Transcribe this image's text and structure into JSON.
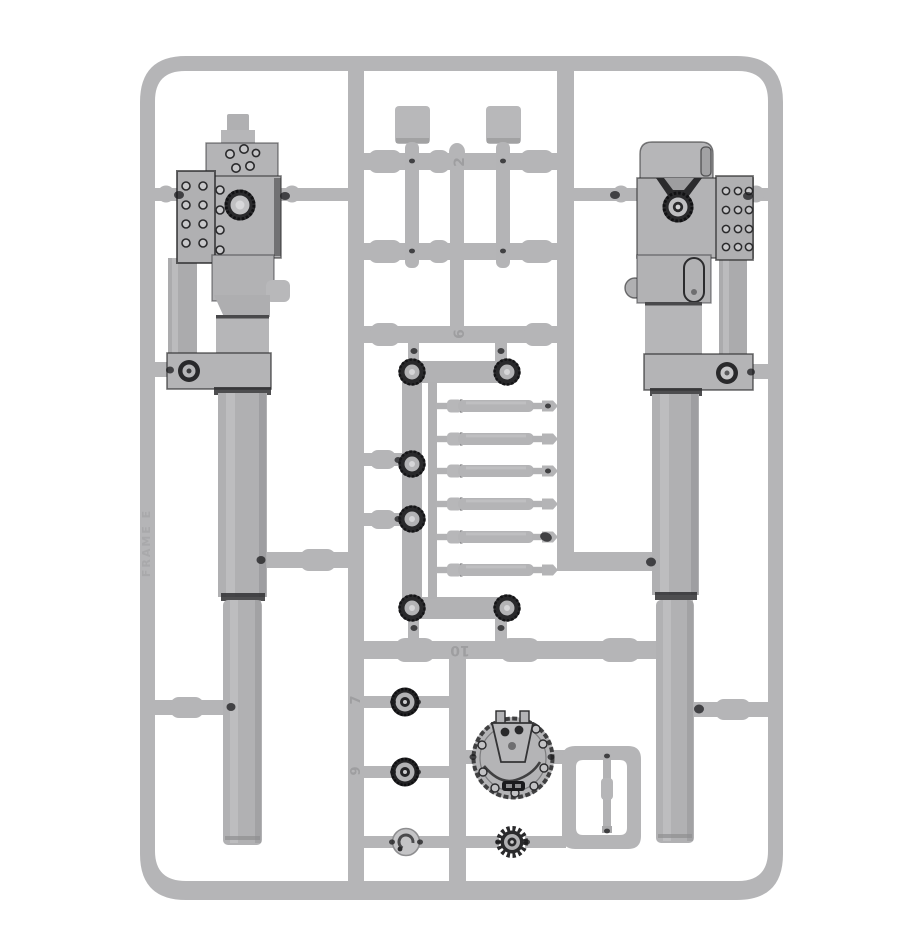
{
  "scene": {
    "description": "Photograph of a grey plastic model-kit sprue (runner frame) holding two heavy cannon assemblies on the sides and small parts in the middle: two flat posts, two trail brackets with eyelet rings, six recoil piston rods, two wheel hubs, a hub cap, a toothed gear, a riveted circular mount plate, a small pin inside a sub-frame.",
    "background_color": "#ffffff",
    "plastic_color": "#b5b5b7",
    "detail_color": "#232325"
  },
  "sprue": {
    "frame_label": "FRAME E",
    "part_numbers": {
      "upper_crossbar": "2",
      "middle_crossbar": "6",
      "lower_crossbar": "10",
      "upper_wheel": "7",
      "lower_wheel": "9"
    },
    "parts": [
      {
        "name": "heavy cannon assembly, left",
        "qty": 1
      },
      {
        "name": "heavy cannon assembly, right",
        "qty": 1
      },
      {
        "name": "flat mounting post",
        "qty": 2
      },
      {
        "name": "trail bracket with eyelet bosses",
        "qty": 2
      },
      {
        "name": "recoil piston rod",
        "qty": 6
      },
      {
        "name": "eyelet ring boss",
        "qty": 2
      },
      {
        "name": "wheel hub",
        "qty": 2
      },
      {
        "name": "hub cap",
        "qty": 1
      },
      {
        "name": "toothed gear",
        "qty": 1
      },
      {
        "name": "riveted circular mount plate",
        "qty": 1
      },
      {
        "name": "small pin in sub-frame",
        "qty": 1
      }
    ]
  }
}
